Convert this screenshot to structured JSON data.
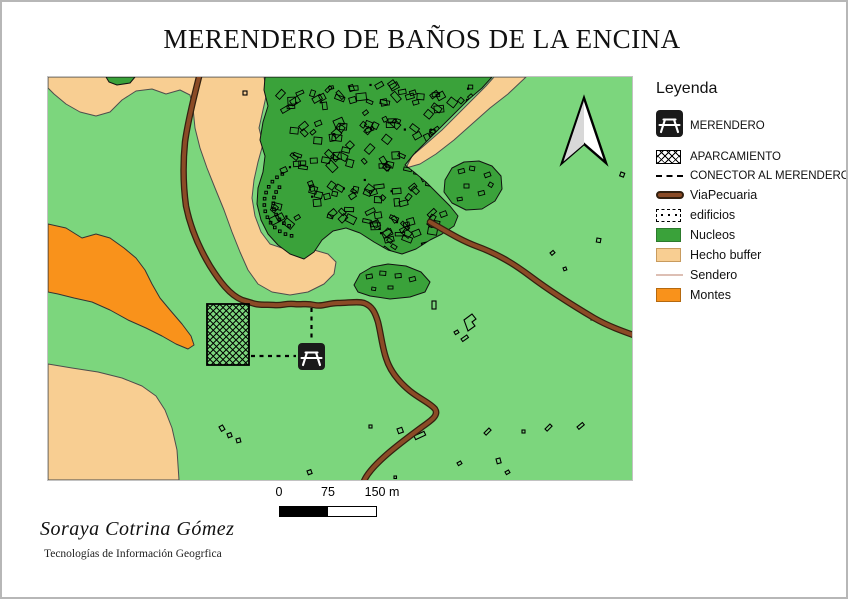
{
  "page": {
    "title": "MERENDERO DE BAÑOS DE LA ENCINA"
  },
  "legend": {
    "title": "Leyenda",
    "items": [
      {
        "id": "merendero",
        "label": "MERENDERO"
      },
      {
        "id": "aparcamiento",
        "label": "APARCAMIENTO"
      },
      {
        "id": "conector",
        "label": "CONECTOR AL MERENDERO"
      },
      {
        "id": "viapecuaria",
        "label": "ViaPecuaria"
      },
      {
        "id": "edificios",
        "label": "edificios"
      },
      {
        "id": "nucleos",
        "label": "Nucleos"
      },
      {
        "id": "hecho_buffer",
        "label": "Hecho buffer"
      },
      {
        "id": "sendero",
        "label": "Sendero"
      },
      {
        "id": "montes",
        "label": "Montes"
      }
    ]
  },
  "scalebar": {
    "labels": [
      "0",
      "75",
      "150 m"
    ]
  },
  "credits": {
    "author": "Soraya Cotrina Gómez",
    "subtitle": "Tecnologías de Información Geogrfica"
  },
  "colors": {
    "land_green": "#7CD67D",
    "nucleos_green": "#3AA23A",
    "buffer_tan": "#F8CE92",
    "montes_orange": "#F9921B",
    "road_brown": "#8B4B26",
    "road_outline": "#33200F",
    "sendero_pink": "#DDBFB4",
    "outline_dark": "#111111",
    "poly_outline": "#4d4d4d",
    "icon_black": "#1a1a1a",
    "arrow_gray": "#d8d8d8"
  }
}
